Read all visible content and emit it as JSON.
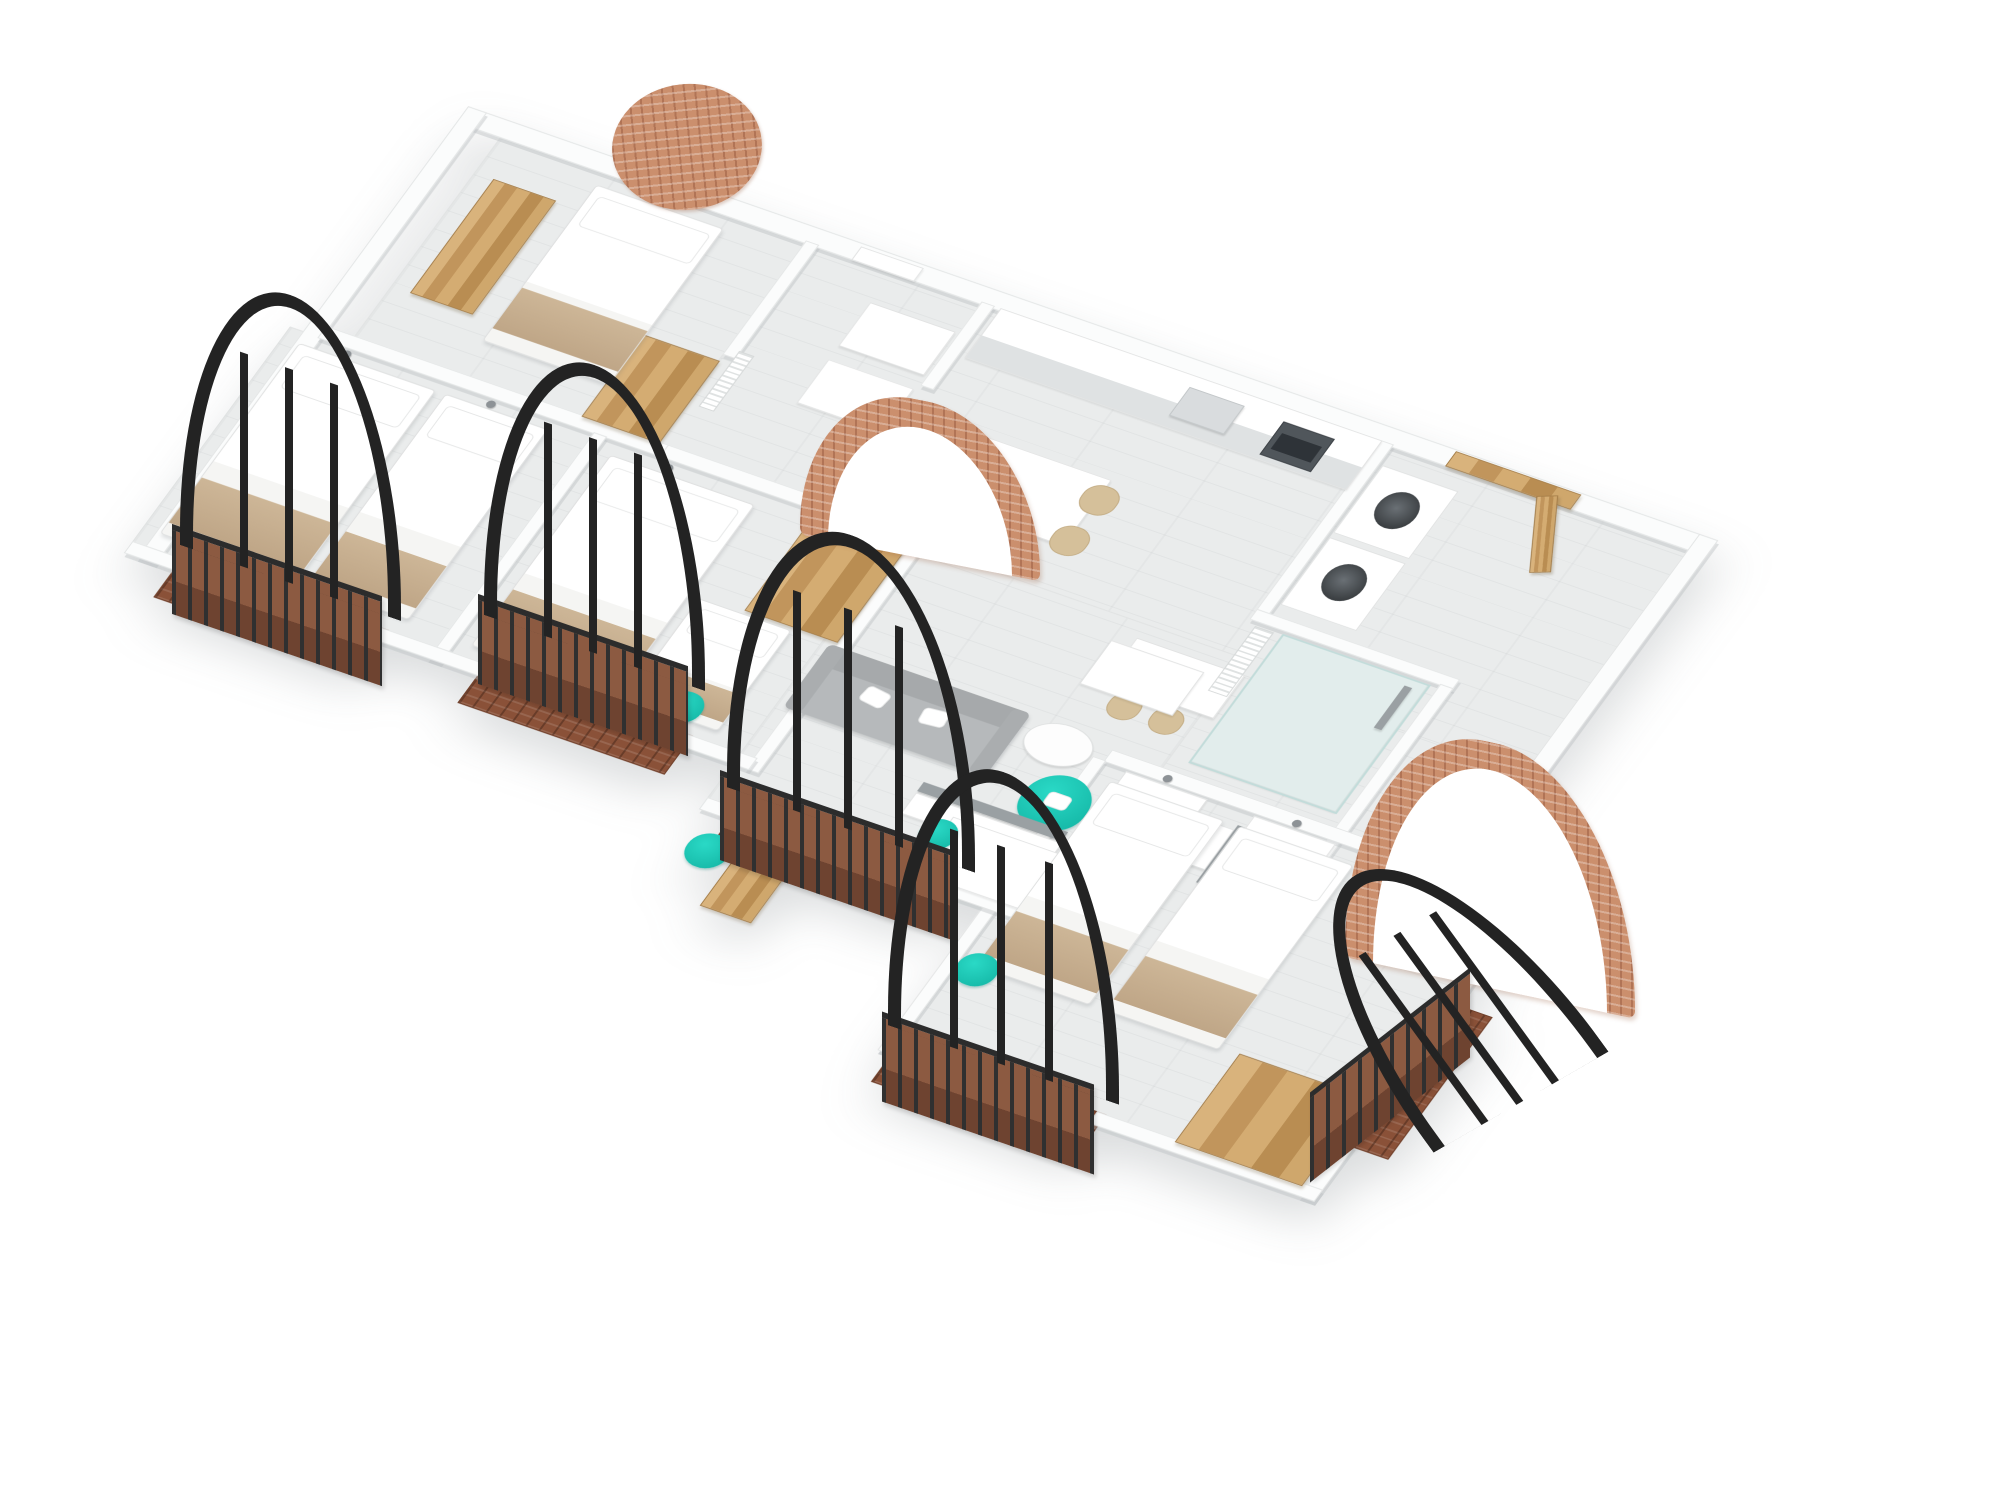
{
  "scene": {
    "title": "3D isometric cutaway floor plan of a white apartment with teal accents",
    "view": "axonometric top-down 3D render on white background",
    "palette": {
      "background": "#ffffff",
      "walls": "#fbfcfc",
      "floor_wood_gray": "#eaecec",
      "wood_oak": "#c89b63",
      "accent_teal": "#17c3b2",
      "brick_copper": "#cb8f6d",
      "balcony_rust": "#8c5a41",
      "iron_black": "#232323",
      "bedding_white": "#ffffff",
      "throw_beige": "#c7b193",
      "sofa_gray": "#b6b9bb"
    },
    "rooms": [
      {
        "name": "bedroom-top-left",
        "furniture": [
          "double-bed",
          "wardrobe",
          "second-wardrobe",
          "wall-lamp",
          "brick-circle-wall-decor"
        ]
      },
      {
        "name": "bathroom-1",
        "furniture": [
          "sink",
          "sink",
          "towel-rail",
          "wall-mirror-door"
        ]
      },
      {
        "name": "kitchen",
        "furniture": [
          "counter-with-sink",
          "built-in-oven",
          "dining-table",
          "beige-chairs-x4",
          "bar-counter",
          "bar-stools-x2"
        ]
      },
      {
        "name": "utility-closet",
        "furniture": [
          "stacked-washer",
          "stacked-dryer"
        ]
      },
      {
        "name": "bathroom-2",
        "furniture": [
          "walk-in-shower",
          "glass-screen",
          "shower-column",
          "vanity-sink",
          "towel-radiator"
        ]
      },
      {
        "name": "entry",
        "furniture": [
          "wood-entry-door-open"
        ]
      },
      {
        "name": "bedroom-left",
        "furniture": [
          "double-bed",
          "single-bed",
          "wall-lamps",
          "arched-balcony-window"
        ]
      },
      {
        "name": "bedroom-middle",
        "furniture": [
          "double-bed",
          "single-bed",
          "wood-wardrobe",
          "teal-chair",
          "brick-arch-doorway",
          "arched-balcony-window"
        ]
      },
      {
        "name": "living-dining",
        "furniture": [
          "gray-sofa",
          "coffee-table",
          "teal-armchair",
          "tv-panel",
          "tv-console",
          "dining-table",
          "teal-chairs-x4",
          "desk",
          "teal-desk-chair",
          "wood-bookcase",
          "teal-lounge-chair",
          "arched-balcony-window"
        ]
      },
      {
        "name": "bedroom-right",
        "furniture": [
          "single-bed",
          "single-bed",
          "head-shelves",
          "wood-wardrobe",
          "teal-chair",
          "brick-arch-wall-decor",
          "arched-balcony-windows-x2"
        ]
      }
    ],
    "features": {
      "arched_iron_windows": 5,
      "juliet_balconies_with_rust_railings": 5,
      "brick_arches": 2,
      "brick_circle_decor": 1,
      "beds_total": 8
    }
  }
}
